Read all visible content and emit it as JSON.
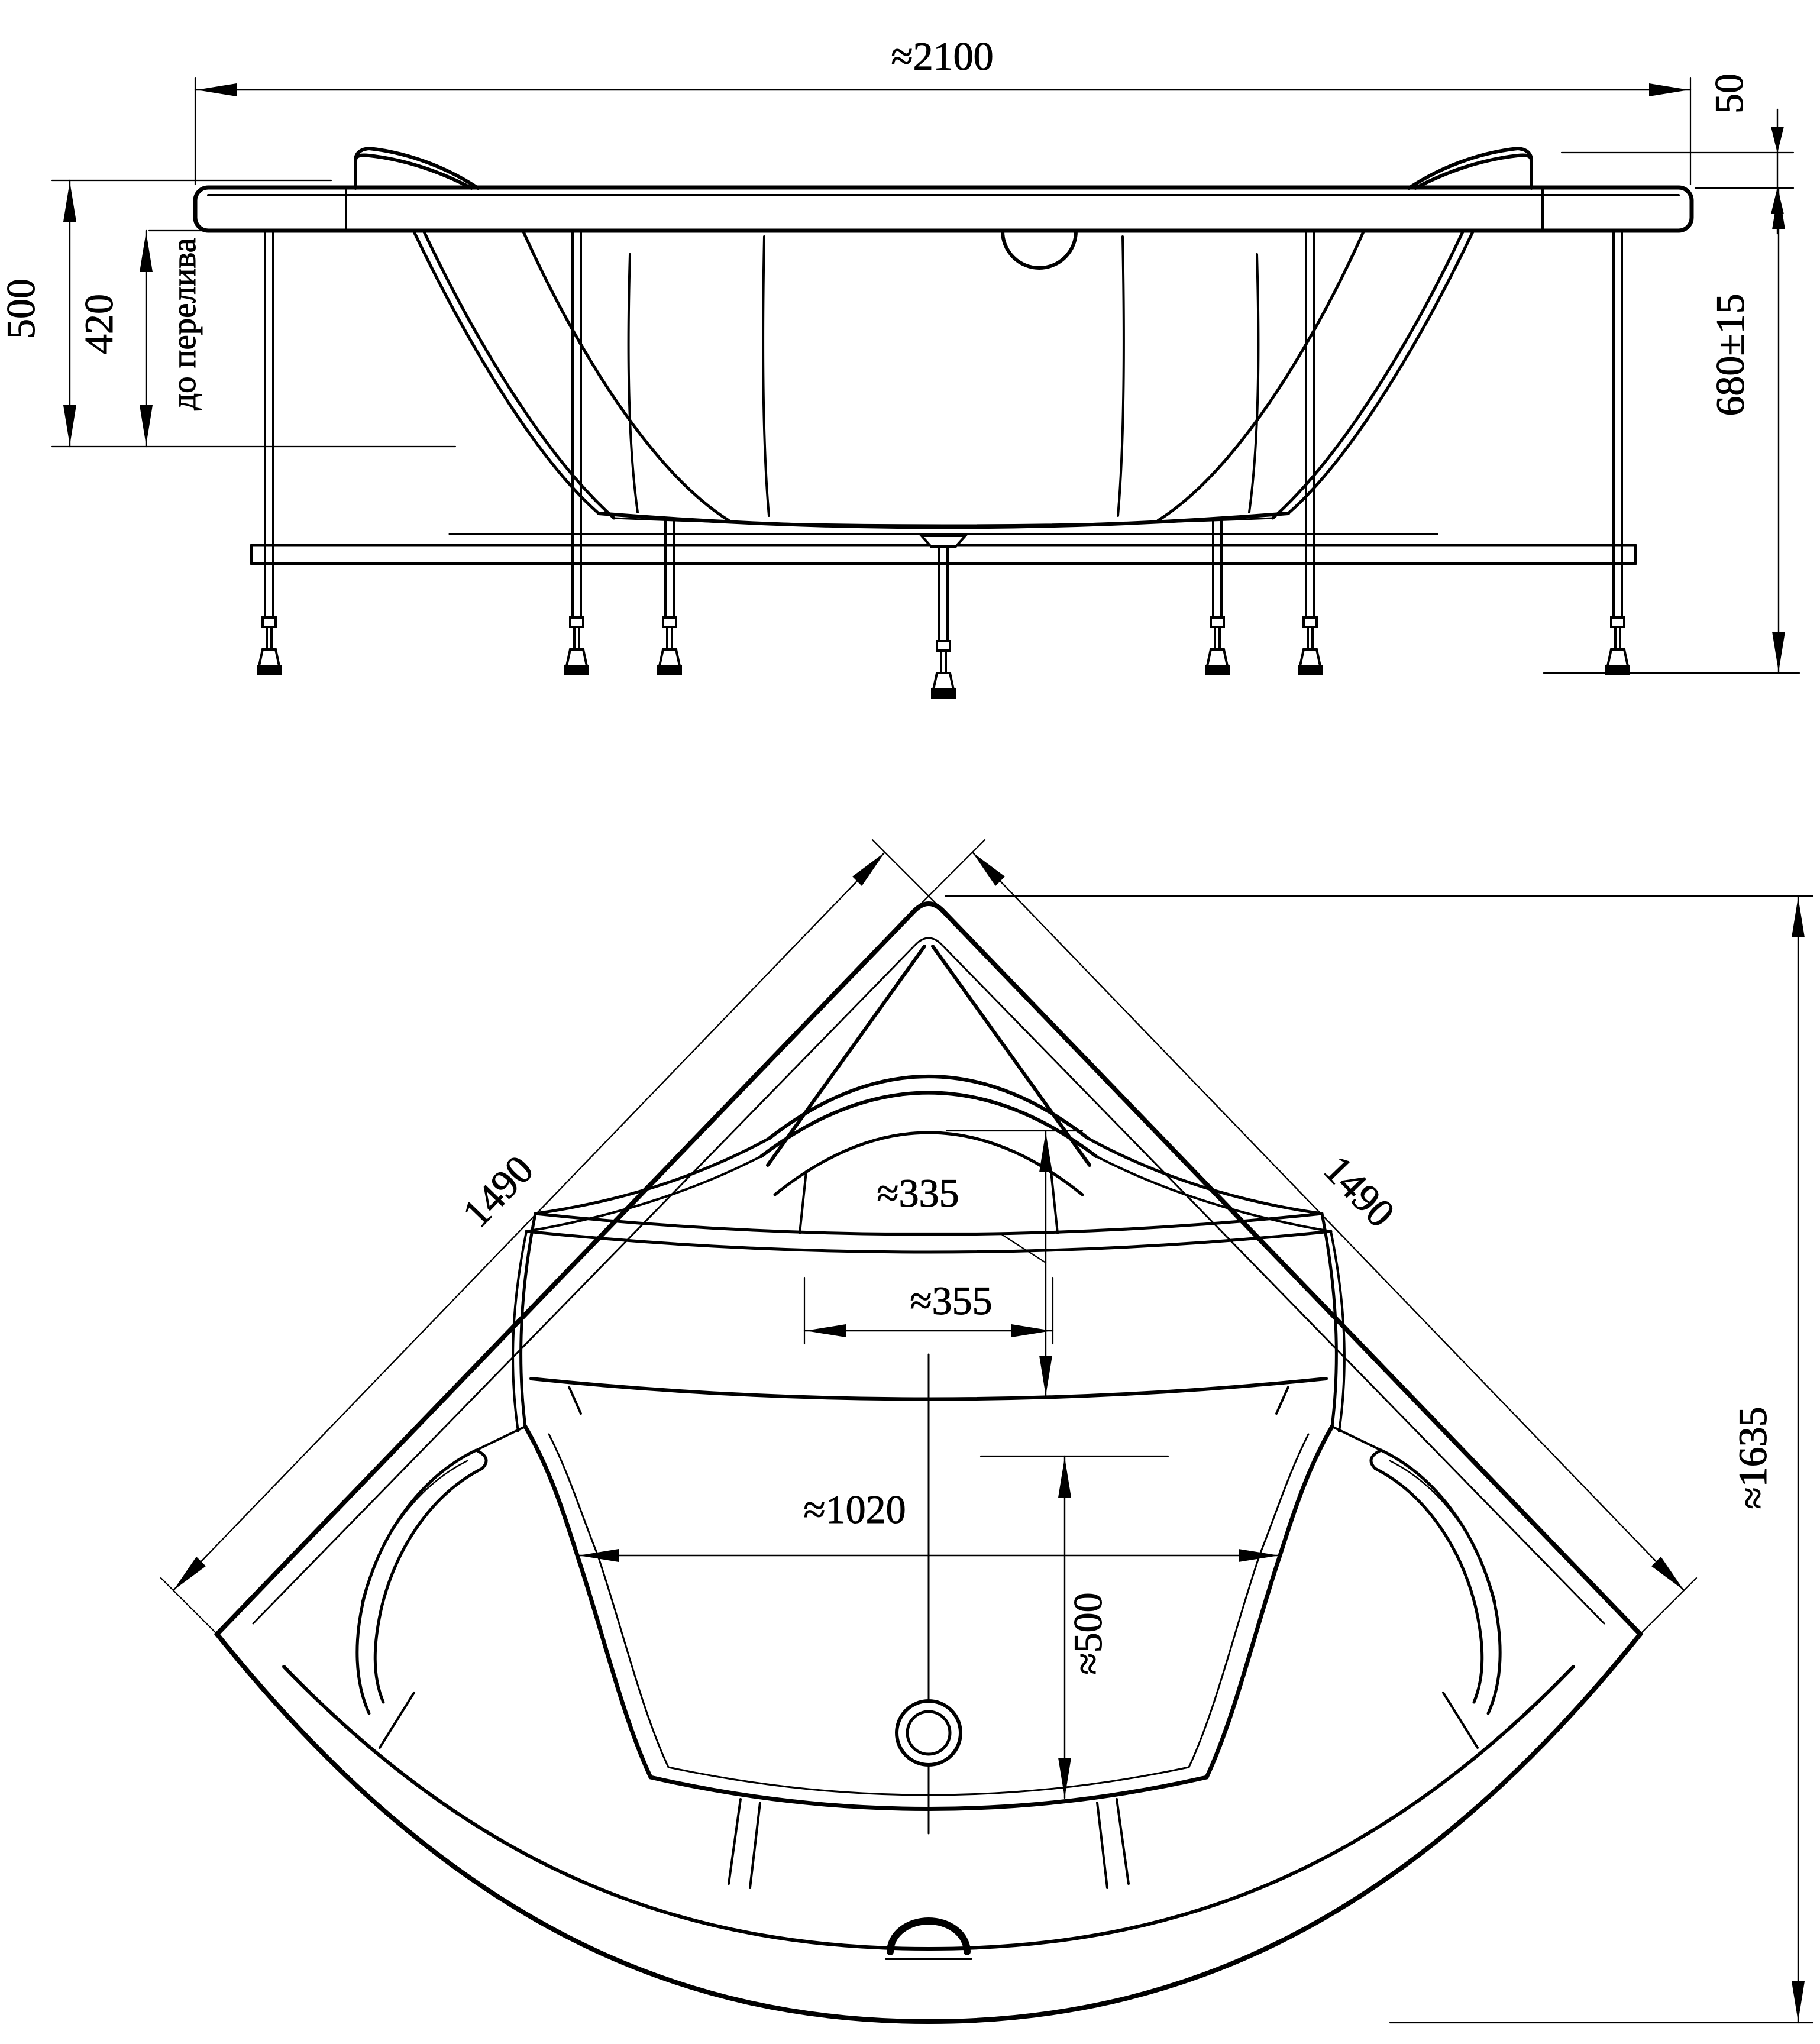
{
  "drawing": {
    "type": "technical-drawing",
    "subject": "corner bathtub with frame, two orthographic views",
    "background": "#ffffff",
    "line_color": "#000000"
  },
  "elevation": {
    "overall_width": "≈2100",
    "headrest_height": "50",
    "total_height": "680±15",
    "depth_total": "500",
    "depth_to_overflow": "420",
    "overflow_note": "до перелива"
  },
  "plan": {
    "side_left": "1490",
    "side_right": "1490",
    "total_depth": "≈1635",
    "bowl_width": "≈1020",
    "drain_offset": "≈500",
    "headrest_depth": "≈335",
    "headrest_width": "≈355"
  }
}
